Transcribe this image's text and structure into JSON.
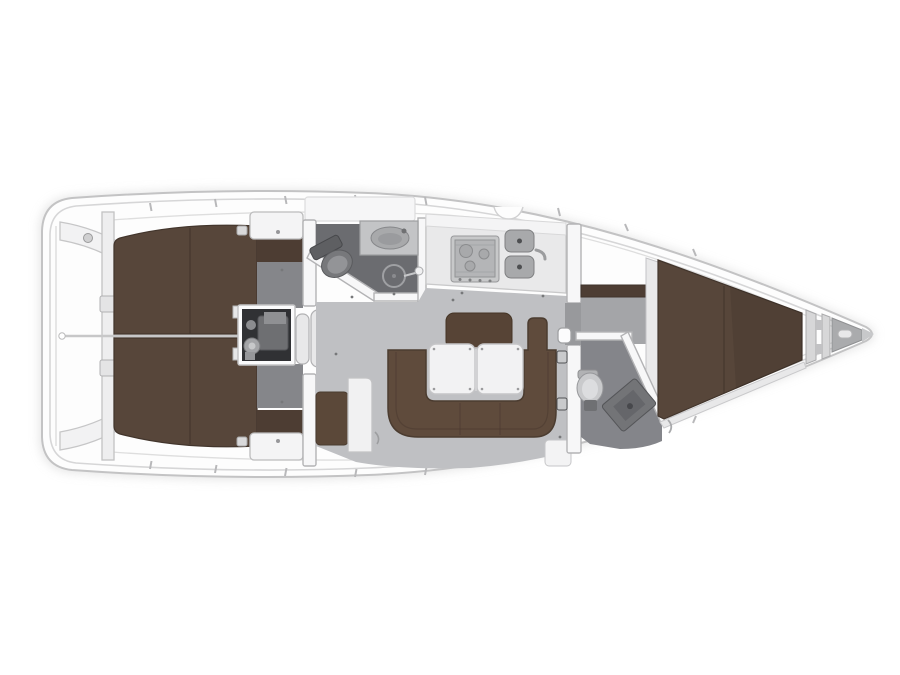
{
  "diagram": {
    "type": "floor-plan",
    "subject": "sailing-yacht-interior",
    "view": "top-down",
    "orientation": "bow-right"
  },
  "areas": [
    {
      "id": "stern-deck"
    },
    {
      "id": "aft-cabin-port"
    },
    {
      "id": "aft-cabin-starboard"
    },
    {
      "id": "engine-compartment"
    },
    {
      "id": "companionway-steps"
    },
    {
      "id": "aft-head"
    },
    {
      "id": "galley"
    },
    {
      "id": "salon"
    },
    {
      "id": "forward-head"
    },
    {
      "id": "forward-cabin"
    },
    {
      "id": "anchor-locker"
    }
  ],
  "colors": {
    "background": "#ffffff",
    "hull_fill": "#fdfdfd",
    "hull_stroke": "#c3c3c4",
    "shadow": "#d2d2d2",
    "wall": "#f7f7f8",
    "berth": "#57463a",
    "berth_strip": "#4d3d33",
    "berth_seam": "#42352c",
    "sofa": "#5f4b3c",
    "sofa_back": "#574436",
    "bench": "#5b4839",
    "table": "#f2f2f3",
    "salon_floor": "#bfc0c3",
    "cabin_floor": "#85868a",
    "entrance_floor": "#a4a5a8",
    "doorway_floor": "#98999c",
    "head_floor_aft": "#6b6c70",
    "head_floor_fwd": "#84858a",
    "counter": "#e9e9ea",
    "stove": "#b4b5b7",
    "sink": "#a8a9ab",
    "engine_bg": "#303134",
    "engine_part": "#6e6f72",
    "step": "#e8e8e9",
    "fixture": "#d6d7d9",
    "toilet_dark": "#77787b",
    "vanity": "#737477",
    "locker_interior": "#aaabad"
  }
}
